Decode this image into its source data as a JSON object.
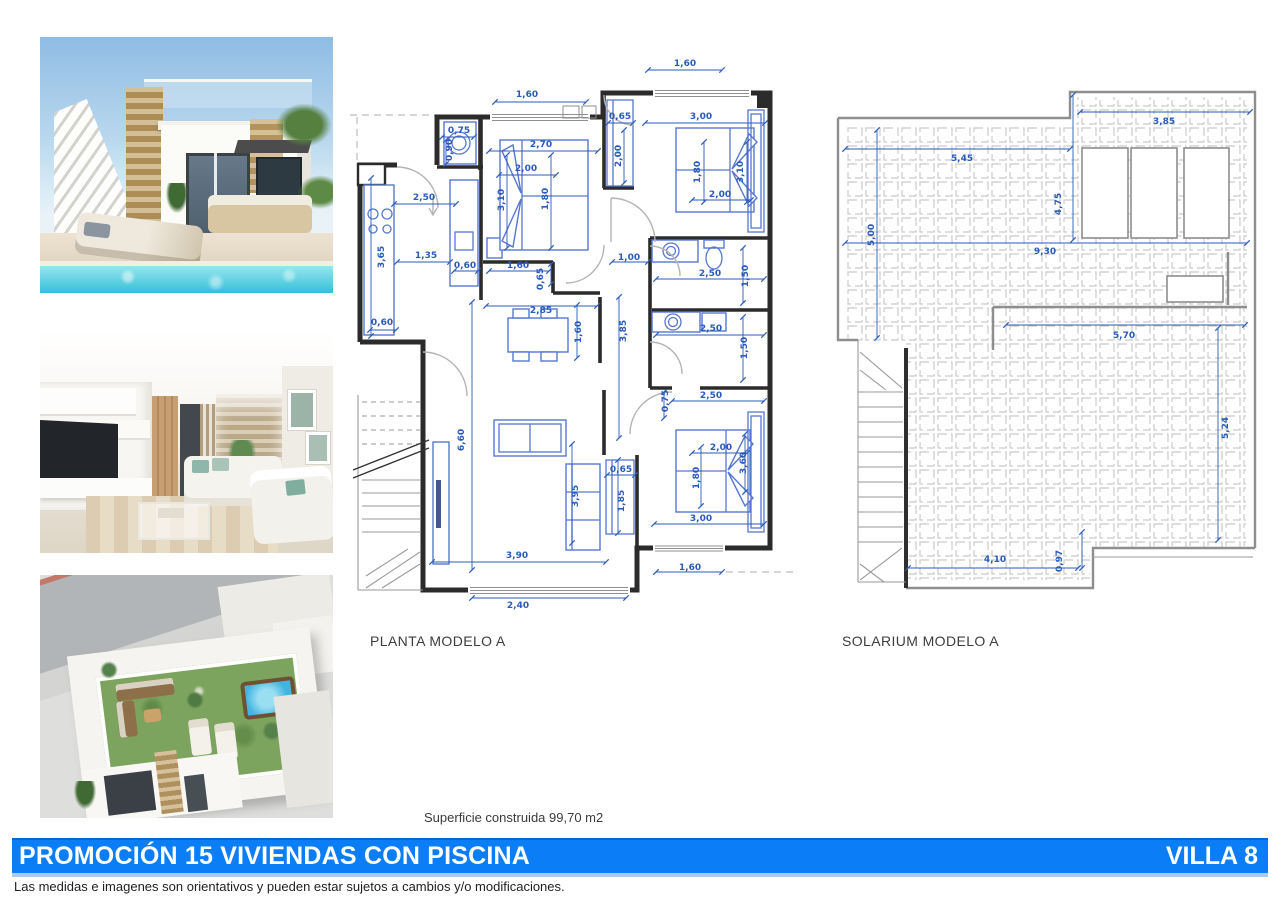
{
  "colors": {
    "banner_blue": "#0b7ef7",
    "banner_border_top": "#0566d8",
    "banner_border_bottom": "#b3c6e8",
    "dimension_blue": "#2a5bb8",
    "furniture_blue": "#5677cf",
    "wall_dark": "#2b2b2b",
    "tile_grid_gray": "#cacaca"
  },
  "planta": {
    "title": "PLANTA MODELO A",
    "dimensions": [
      {
        "t": "1,60",
        "x": 685,
        "y": 66
      },
      {
        "t": "1,60",
        "x": 527,
        "y": 97
      },
      {
        "t": "0,75",
        "x": 459,
        "y": 133
      },
      {
        "t": "0,90",
        "x": 452,
        "y": 150,
        "r": 1
      },
      {
        "t": "2,70",
        "x": 541,
        "y": 147
      },
      {
        "t": "2,00",
        "x": 526,
        "y": 171
      },
      {
        "t": "3,10",
        "x": 504,
        "y": 200,
        "r": 1
      },
      {
        "t": "1,80",
        "x": 548,
        "y": 199,
        "r": 1
      },
      {
        "t": "0,65",
        "x": 620,
        "y": 119
      },
      {
        "t": "3,00",
        "x": 701,
        "y": 119
      },
      {
        "t": "2,00",
        "x": 621,
        "y": 156,
        "r": 1
      },
      {
        "t": "1,80",
        "x": 700,
        "y": 172,
        "r": 1
      },
      {
        "t": "3,10",
        "x": 743,
        "y": 172,
        "r": 1
      },
      {
        "t": "2,00",
        "x": 720,
        "y": 197
      },
      {
        "t": "2,50",
        "x": 424,
        "y": 200
      },
      {
        "t": "3,65",
        "x": 384,
        "y": 257,
        "r": 1
      },
      {
        "t": "1,35",
        "x": 426,
        "y": 258
      },
      {
        "t": "0,60",
        "x": 465,
        "y": 268
      },
      {
        "t": "1,60",
        "x": 518,
        "y": 268
      },
      {
        "t": "0,65",
        "x": 543,
        "y": 279,
        "r": 1
      },
      {
        "t": "1,00",
        "x": 629,
        "y": 260
      },
      {
        "t": "2,50",
        "x": 710,
        "y": 276
      },
      {
        "t": "1,50",
        "x": 748,
        "y": 276,
        "r": 1
      },
      {
        "t": "0,60",
        "x": 382,
        "y": 325
      },
      {
        "t": "2,85",
        "x": 541,
        "y": 313
      },
      {
        "t": "1,60",
        "x": 581,
        "y": 332,
        "r": 1
      },
      {
        "t": "3,85",
        "x": 626,
        "y": 331,
        "r": 1
      },
      {
        "t": "2,50",
        "x": 711,
        "y": 331
      },
      {
        "t": "1,50",
        "x": 747,
        "y": 348,
        "r": 1
      },
      {
        "t": "0,75",
        "x": 668,
        "y": 401,
        "r": 1
      },
      {
        "t": "2,50",
        "x": 711,
        "y": 398
      },
      {
        "t": "6,60",
        "x": 464,
        "y": 440,
        "r": 1
      },
      {
        "t": "2,00",
        "x": 721,
        "y": 450
      },
      {
        "t": "1,80",
        "x": 699,
        "y": 478,
        "r": 1
      },
      {
        "t": "3,60",
        "x": 746,
        "y": 463,
        "r": 1
      },
      {
        "t": "0,65",
        "x": 621,
        "y": 472
      },
      {
        "t": "1,85",
        "x": 624,
        "y": 501,
        "r": 1
      },
      {
        "t": "3,95",
        "x": 578,
        "y": 496,
        "r": 1
      },
      {
        "t": "3,00",
        "x": 701,
        "y": 521
      },
      {
        "t": "3,90",
        "x": 517,
        "y": 558
      },
      {
        "t": "1,60",
        "x": 690,
        "y": 570
      },
      {
        "t": "2,40",
        "x": 518,
        "y": 608
      }
    ]
  },
  "solarium": {
    "title": "SOLARIUM MODELO A",
    "dimensions": [
      {
        "t": "3,85",
        "x": 1164,
        "y": 124
      },
      {
        "t": "5,45",
        "x": 962,
        "y": 161
      },
      {
        "t": "4,75",
        "x": 1061,
        "y": 204,
        "r": 1
      },
      {
        "t": "5,00",
        "x": 874,
        "y": 235,
        "r": 1
      },
      {
        "t": "9,30",
        "x": 1045,
        "y": 254
      },
      {
        "t": "5,70",
        "x": 1124,
        "y": 338
      },
      {
        "t": "5,24",
        "x": 1228,
        "y": 428,
        "r": 1
      },
      {
        "t": "4,10",
        "x": 995,
        "y": 562
      },
      {
        "t": "0,97",
        "x": 1062,
        "y": 561,
        "r": 1
      }
    ]
  },
  "superficie_label": "Superficie construida 99,70 m2",
  "banner": {
    "title": "PROMOCIÓN 15 VIVIENDAS CON PISCINA",
    "villa": "VILLA 8"
  },
  "disclaimer": "Las medidas e imagenes son orientativos y pueden estar sujetos a cambios y/o modificaciones."
}
